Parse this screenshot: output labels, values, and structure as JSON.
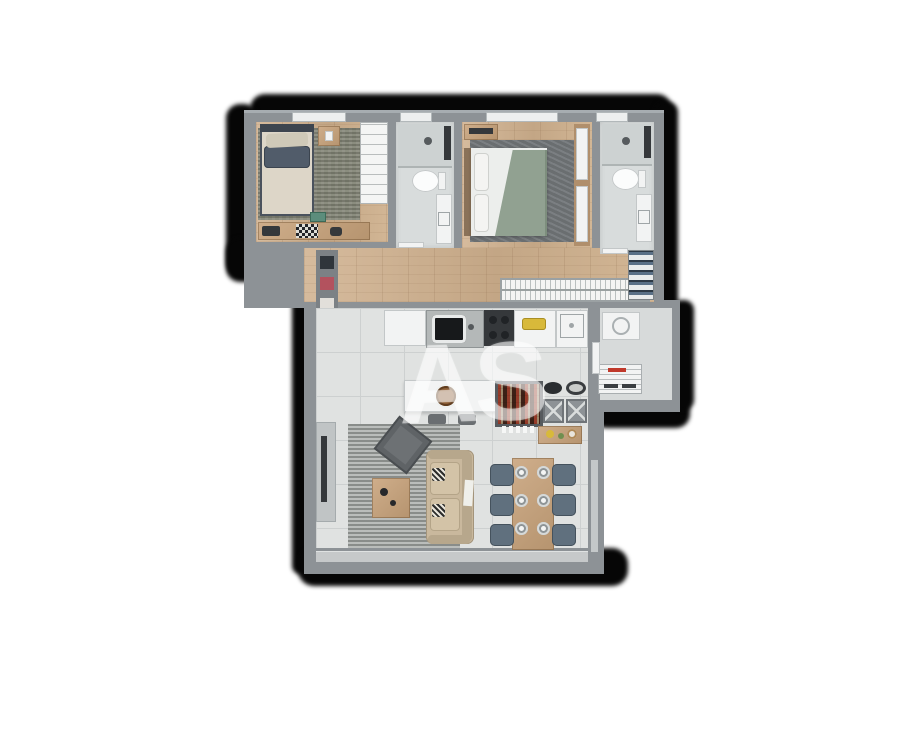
{
  "watermark": {
    "text": "AS"
  },
  "palette": {
    "shadow": "#060606",
    "wall": "#8d9296",
    "wall-light": "#a7adb1",
    "wood": "#cfb394",
    "tile": "#e0e2e1",
    "tile-line": "#cdd0d0",
    "bath-floor": "#d8dcdc",
    "rug-olive": "#7e8071",
    "rug-dark": "#73777a",
    "rug-living": "#a3a7a4",
    "bed-blanket": "#ddd6c8",
    "pillow-slate": "#515c6a",
    "duvet-sage": "#91a191",
    "sheet-white": "#eceeec",
    "sofa-beige": "#c9b89d",
    "chair-slate": "#60707e",
    "counter-white": "#f2f3f3",
    "appliance-dark": "#35383b",
    "accent-yellow": "#d8b93a",
    "accent-red": "#b3525e",
    "accent-teal": "#3f9aa3",
    "accent-pink": "#c38ca3",
    "window": "#edefef"
  },
  "plan": {
    "type": "apartment-floor-plan-top-view",
    "rooms": [
      {
        "name": "bedroom",
        "furniture": [
          "single-bed",
          "nightstand",
          "area-rug",
          "desk-with-chessboard",
          "open-wardrobe-shelves"
        ]
      },
      {
        "name": "bathroom-1",
        "furniture": [
          "shower",
          "toilet",
          "vanity-sink"
        ]
      },
      {
        "name": "master-bedroom",
        "furniture": [
          "double-bed-sage-duvet",
          "tv-dresser",
          "area-rug",
          "wardrobe"
        ]
      },
      {
        "name": "bathroom-2",
        "furniture": [
          "shower",
          "toilet",
          "vanity-sink"
        ]
      },
      {
        "name": "hallway",
        "furniture": [
          "hanging-closet-rail",
          "shoe-rack",
          "niche-shelf-with-decor"
        ]
      },
      {
        "name": "kitchen",
        "furniture": [
          "fridge",
          "sink-counter",
          "cooktop",
          "cutting-board-counter",
          "laundry-sink",
          "island-with-stools",
          "bar-shelf",
          "gray-cabinets",
          "pans",
          "fruit-console"
        ]
      },
      {
        "name": "laundry-service",
        "furniture": [
          "washing-machine",
          "drying-rack"
        ]
      },
      {
        "name": "living-room",
        "furniture": [
          "tv-panel",
          "armchair",
          "sofa",
          "coffee-table",
          "area-rug"
        ]
      },
      {
        "name": "dining",
        "furniture": [
          "dining-table",
          "six-chairs",
          "place-settings"
        ]
      }
    ]
  }
}
